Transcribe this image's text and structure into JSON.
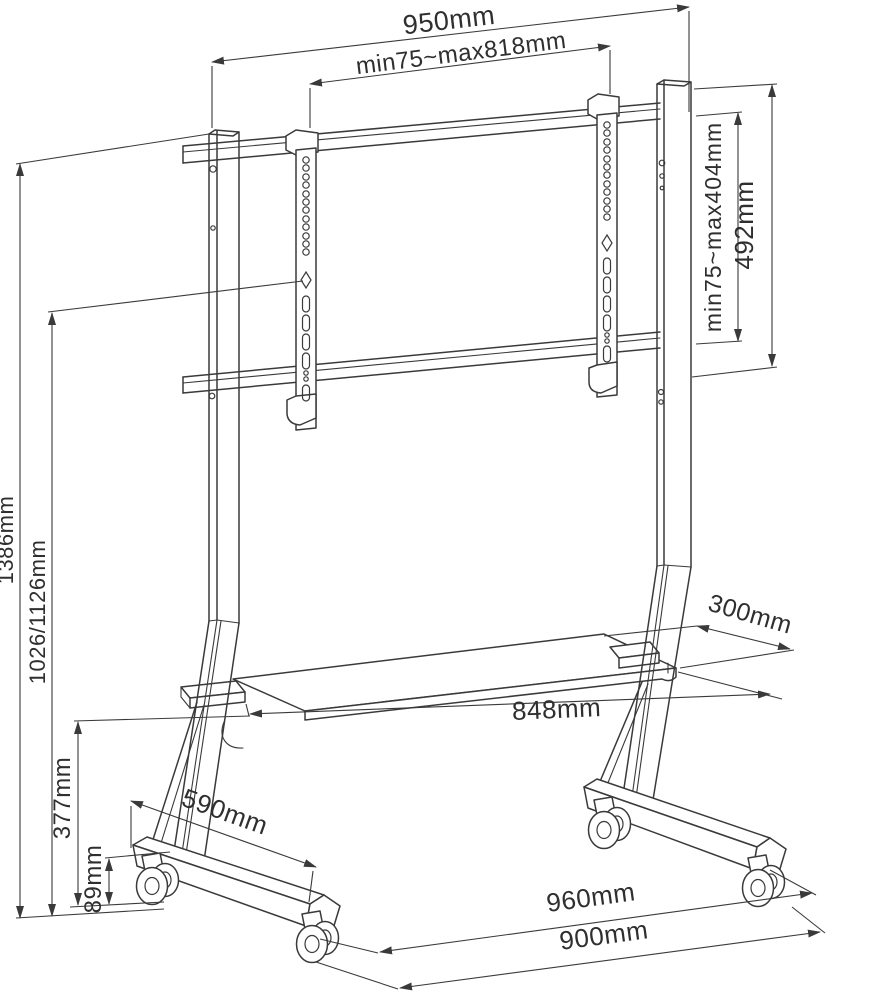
{
  "diagram": {
    "colors": {
      "background": "#ffffff",
      "line": "#3a3a3a",
      "text": "#2f2f2f"
    },
    "labels": {
      "top_outer": "950mm",
      "top_inner": "min75~max818mm",
      "right_inner": "min75~max404mm",
      "right_outer": "492mm",
      "left_outer": "1386mm",
      "left_inner": "1026/1126mm",
      "left_mid": "377mm",
      "left_low": "89mm",
      "foot_length": "590mm",
      "shelf_width": "848mm",
      "shelf_depth": "300mm",
      "base_outer": "960mm",
      "base_inner": "900mm"
    }
  }
}
